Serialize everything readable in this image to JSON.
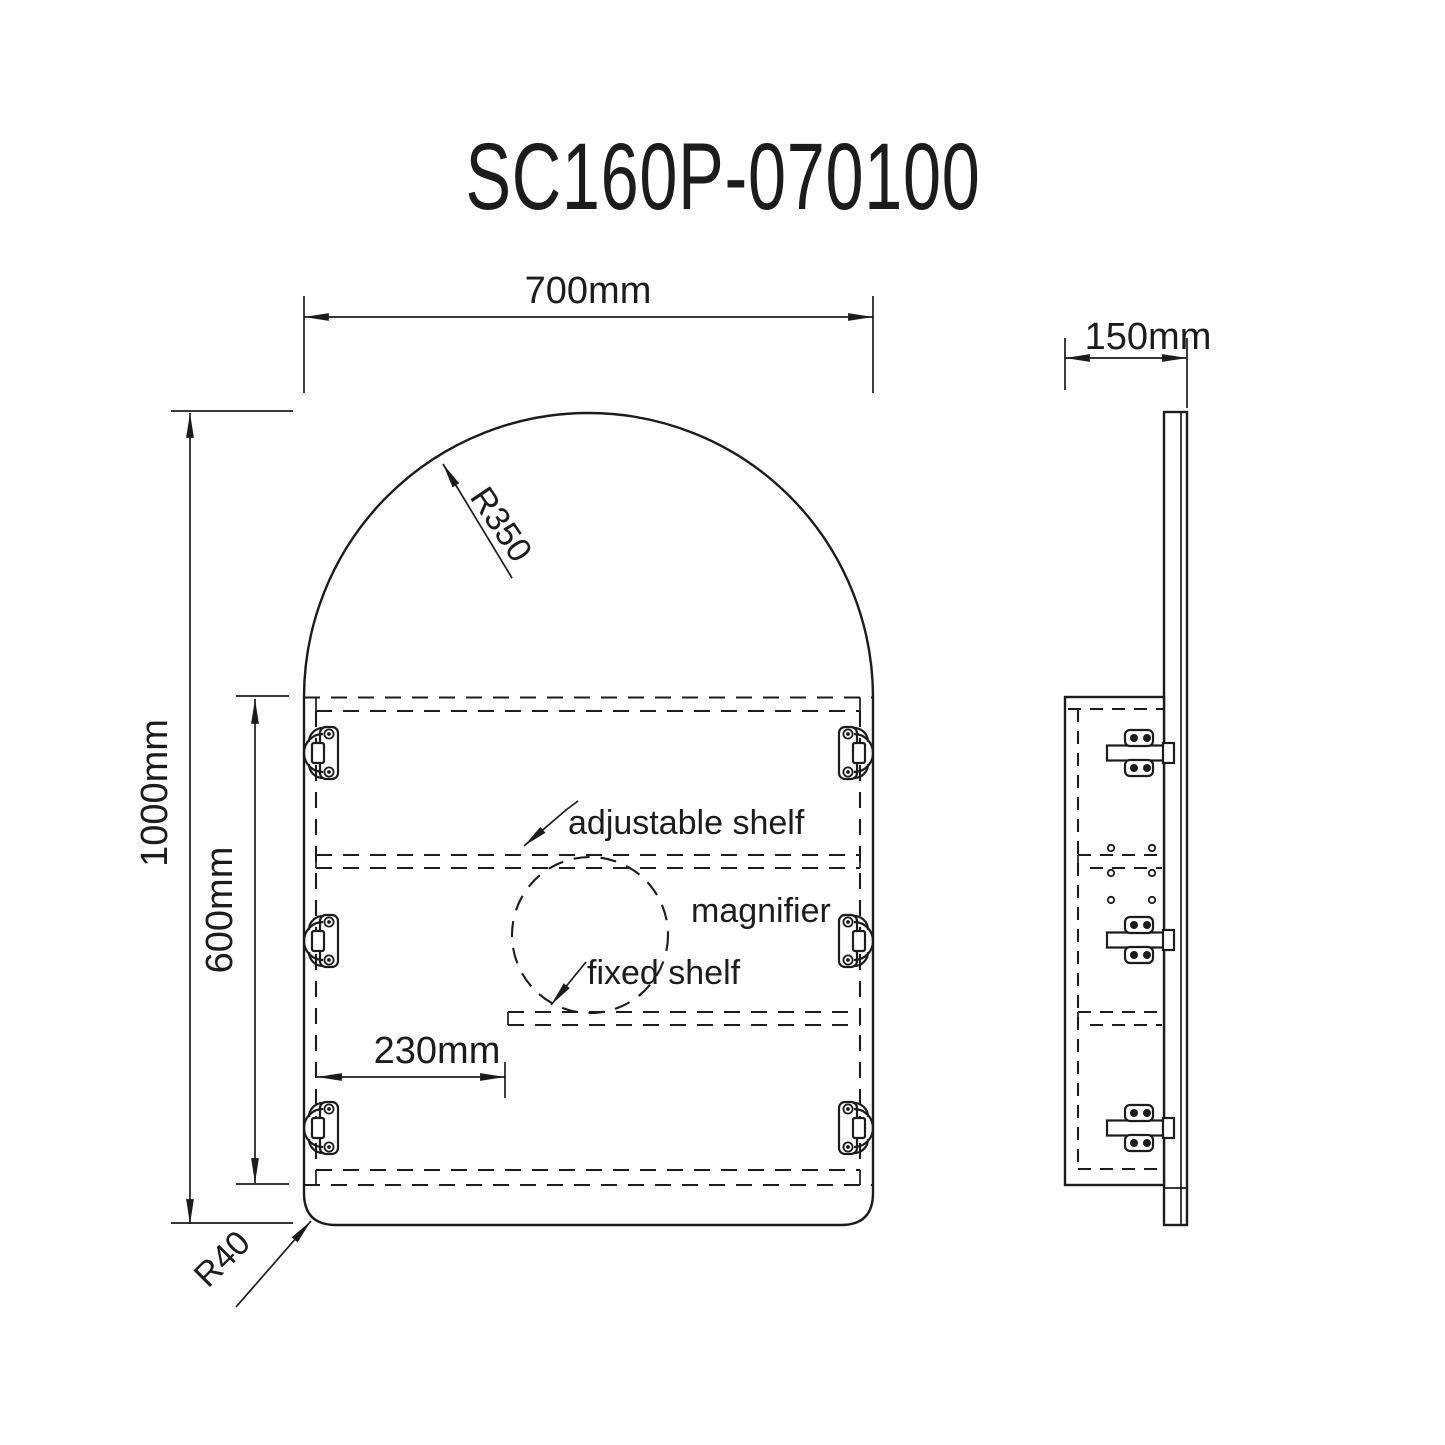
{
  "title": "SC160P-070100",
  "front_view": {
    "width_label": "700mm",
    "height_label": "1000mm",
    "interior_height_label": "600mm",
    "fixed_shelf_offset_label": "230mm",
    "arch_radius_label": "R350",
    "corner_radius_label": "R40",
    "adjustable_shelf_label": "adjustable shelf",
    "magnifier_label": "magnifier",
    "fixed_shelf_label": "fixed shelf"
  },
  "side_view": {
    "depth_label": "150mm"
  },
  "colors": {
    "line": "#1c1c1c",
    "background": "#ffffff"
  }
}
